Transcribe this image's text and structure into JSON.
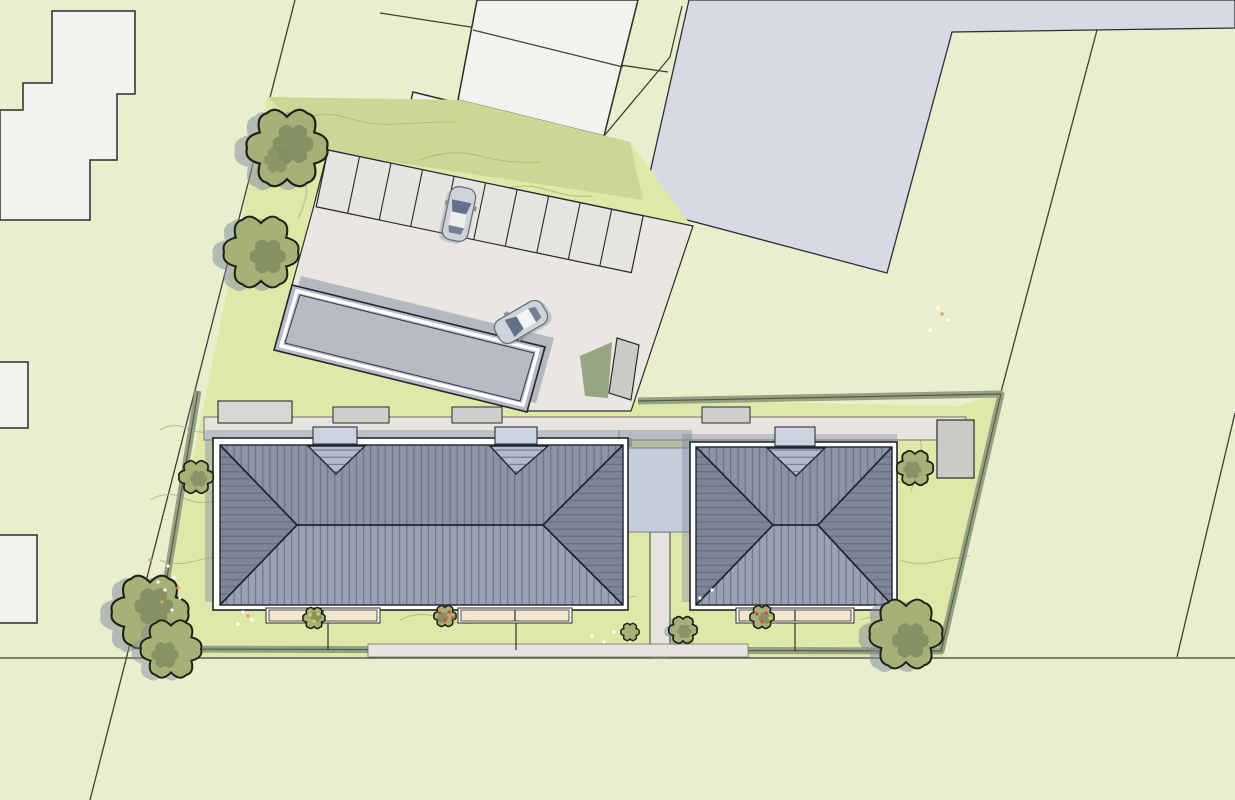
{
  "document": {
    "type": "architectural-site-plan",
    "view": "top-down",
    "visible_text": []
  },
  "colors": {
    "site_bg": "#e9efcc",
    "garden": "#dfe7a9",
    "garden_strip": "#ccd795",
    "contour": "#aab56e",
    "hedge": "#94a183",
    "hedge_dark": "#49523c",
    "boundary_line": "#3c4137",
    "outline": "#2a2d28",
    "neighbor_fill": "#f2f2ee",
    "blue_building": "#d5dae4",
    "path": "#e7e4e0",
    "drive": "#eae7e2",
    "parking_space": "#e6e4e0",
    "carport": "#b6bbc6",
    "shed": "#c9cbc7",
    "bin_store": "#cdd0cc",
    "roof_main": "#8b93a6",
    "roof_light": "#99a1b3",
    "roof_hip": "#7d8598",
    "roof_line": "#5d6476",
    "roof_edge": "#20242e",
    "wall_white": "#ffffff",
    "porch": "#ccd3e0",
    "canopy": "#b4bccb",
    "connector": "#c6cdda",
    "terrace": "#f2e6d1",
    "tree_fill": "#a6b077",
    "tree_dark": "#7f8c5f",
    "tree_outline": "#1d2415",
    "shadow": "#7e8a9b",
    "dark_planting": "#8e9d78",
    "car_body": "#d0d4d9",
    "car_glass": "#61718c",
    "flower_red": "#d34f3f",
    "flower_orange": "#e2a05a",
    "flower_yellow": "#e0c84e",
    "flower_white": "#ffffff"
  },
  "site": {
    "main_buildings": 2,
    "roof_type": "hipped",
    "entrance_porches": 3,
    "entrance_canopies": 3,
    "terraces": 3,
    "connector_between_buildings": 1,
    "carport": 1,
    "parking_spaces": 10,
    "parked_cars": 1,
    "moving_cars": 1,
    "large_trees": 7,
    "garden_shrubs": 5,
    "sheds": 2,
    "bin_stores": 4,
    "neighbor_buildings": 5,
    "boundary_hedges": true,
    "road_along_bottom": true
  }
}
